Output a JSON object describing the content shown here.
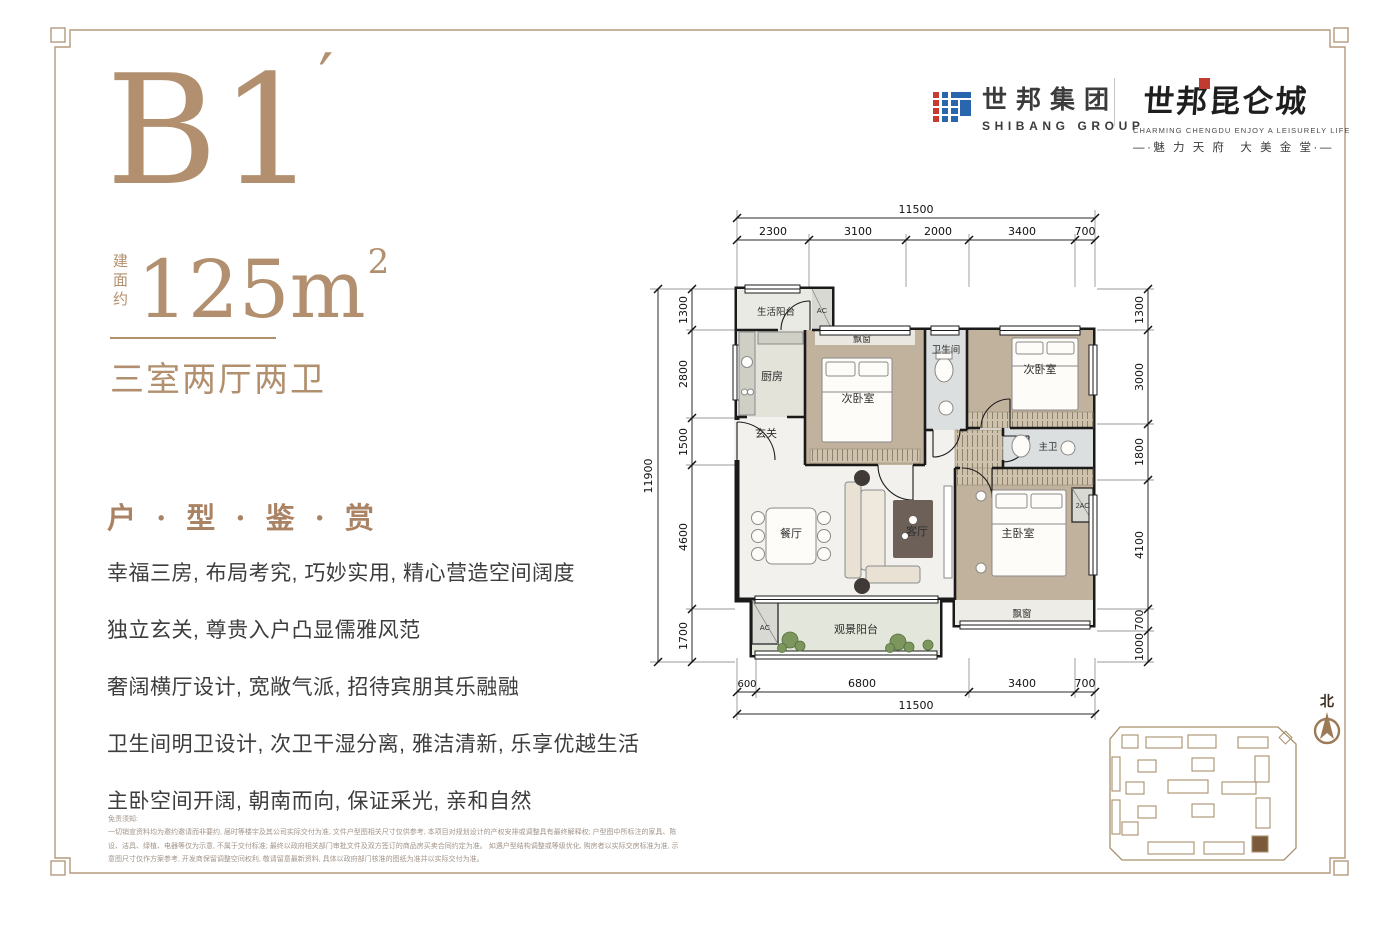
{
  "page": {
    "accent": "#b2906f",
    "frame_color": "#b59a7d"
  },
  "unit": {
    "code": "B1",
    "prime": "′",
    "area_label_vertical": "建面约",
    "area_value": "125m",
    "area_exponent": "2",
    "layout_type": "三室两厅两卫"
  },
  "section": {
    "title": "户 · 型 · 鉴 · 赏",
    "features": [
      "幸福三房, 布局考究, 巧妙实用, 精心营造空间阔度",
      "独立玄关, 尊贵入户凸显儒雅风范",
      "奢阔横厅设计, 宽敞气派, 招待宾朋其乐融融",
      "卫生间明卫设计, 次卫干湿分离, 雅洁清新, 乐享优越生活",
      "主卧空间开阔, 朝南而向, 保证采光, 亲和自然"
    ]
  },
  "disclaimer": {
    "title": "免责须知:",
    "line1": "一切销宣资料均为邀约邀请而非要约, 届时等楼宇及其公司实际交付为准, 文件户型图相关尺寸仅供参考, 本项目对规划设计的产权安排或调整具有最终解释权; 户型图中所标注的家具、陈设、洁具、绿植、电器等仅为示意, 不属于交付标准; 最终以政府相关部门审批文件及双方签订的商品房买卖合同约定为准。",
    "line2": "如遇户型结构调整或等级优化, 购房者以实际交房标准为准, 示意图尺寸仅作方案参考, 开发商保留调整空间权利, 敬请留意最新资料, 具体以政府部门核准的图纸为准并以实际交付为准。"
  },
  "brand": {
    "group_name_cn": "世邦集团",
    "group_name_en": "SHIBANG GROUP",
    "project_name_cn": "世邦昆仑城",
    "project_tagline_en": "CHARMING CHENGDU   ENJOY A LEISURELY LIFE",
    "project_slogan_cn": "—·魅 力 天 府　大 美 金 堂·—"
  },
  "floorplan": {
    "dims_top": {
      "total": "11500",
      "segments": [
        "2300",
        "3100",
        "2000",
        "3400",
        "700"
      ]
    },
    "dims_left": {
      "total": "11900",
      "segments": [
        "1300",
        "2800",
        "1500",
        "4600",
        "1700"
      ]
    },
    "dims_right": {
      "segments": [
        "1300",
        "3000",
        "1800",
        "4100",
        "700",
        "1000"
      ]
    },
    "dims_bottom": {
      "total": "11500",
      "segments": [
        "600",
        "6800",
        "3400",
        "700"
      ]
    },
    "rooms": {
      "service_balcony": "生活阳台",
      "ac_top": "AC",
      "kitchen": "厨房",
      "bay_window_1": "飘窗",
      "bedroom_2": "次卧室",
      "bathroom": "卫生间",
      "bedroom_3": "次卧室",
      "foyer": "玄关",
      "master_bath": "主卫",
      "dining": "餐厅",
      "living": "客厅",
      "master_bedroom": "主卧室",
      "ac_2": "2AC",
      "bay_window_2": "飘窗",
      "view_balcony": "观景阳台",
      "ac_balcony": "AC"
    }
  },
  "compass": {
    "north_label": "北"
  }
}
